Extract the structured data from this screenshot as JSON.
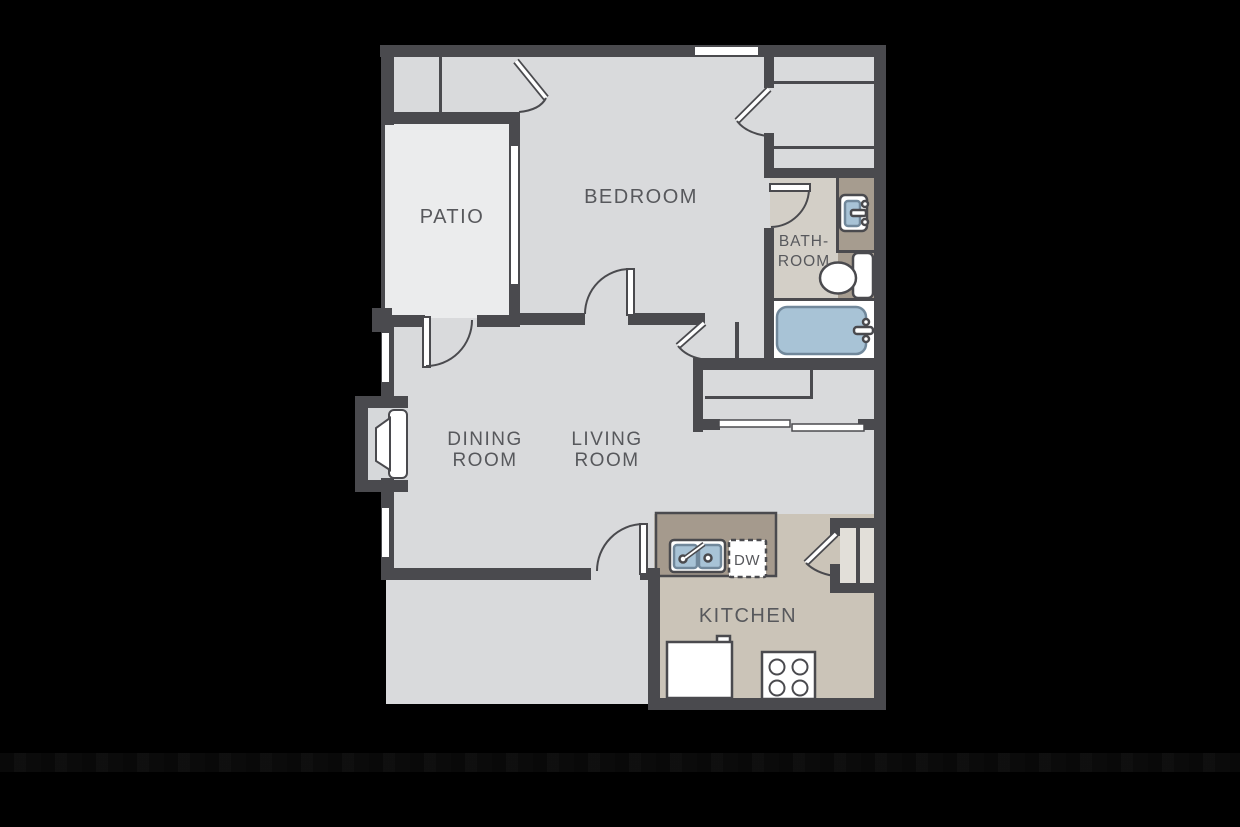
{
  "rooms": {
    "patio": "PATIO",
    "bedroom": "BEDROOM",
    "bathroom_line1": "BATH-",
    "bathroom_line2": "ROOM",
    "dining_line1": "DINING",
    "dining_line2": "ROOM",
    "living_line1": "LIVING",
    "living_line2": "ROOM",
    "kitchen": "KITCHEN"
  },
  "appliances": {
    "dishwasher": "DW"
  },
  "colors": {
    "background": "#000000",
    "wall": "#4a4a4e",
    "room_floor": "#d9dadc",
    "patio_floor": "#ebeced",
    "kitchen_floor": "#cbc4b8",
    "counter": "#a59a8d",
    "bathroom_floor": "#d3cfc7",
    "vanity": "#a69c8f",
    "pantry_floor": "#e2dfd9",
    "fixture_white": "#ffffff",
    "fixture_blue": "#a8c3d6",
    "fixture_blue_border": "#71889b",
    "label_text": "#57585c"
  }
}
